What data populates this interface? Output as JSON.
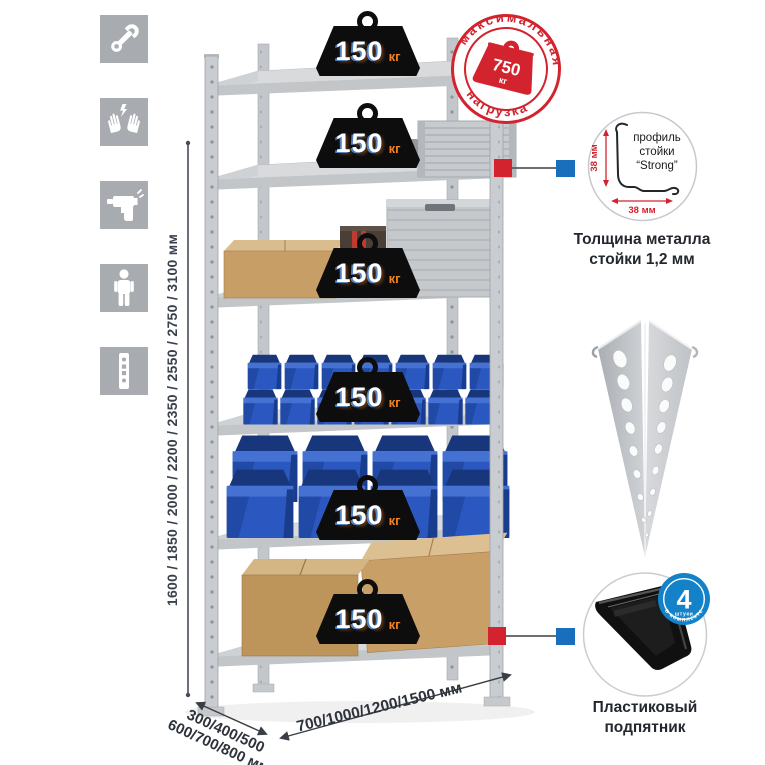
{
  "sidebar_icons": [
    {
      "label": "wrench"
    },
    {
      "label": "gloves"
    },
    {
      "label": "drill"
    },
    {
      "label": "person"
    },
    {
      "label": "perforated-profile"
    }
  ],
  "height_dimension": "1600 / 1850 / 2000 / 2200 / 2350 / 2550 / 2750 / 3100 мм",
  "depth_dimension": {
    "line1": "300/400/500",
    "line2": "600/700/800 мм"
  },
  "width_dimension": "700/1000/1200/1500 мм",
  "shelf_load_badge": {
    "value": "150",
    "unit": "кг"
  },
  "max_load_stamp": {
    "arc_top": "максимальная",
    "arc_bottom": "нагрузка",
    "value": "750",
    "unit": "кг"
  },
  "post_profile": {
    "label_line1": "профиль",
    "label_line2": "стойки",
    "label_line3": "“Strong”",
    "dim_vertical": "38 мм",
    "dim_horizontal": "38 мм",
    "caption_line1": "Толщина металла",
    "caption_line2": "стойки 1,2 мм"
  },
  "plastic_foot": {
    "badge_value": "4",
    "badge_unit": "штуки",
    "badge_arc": "в комплекте",
    "caption_line1": "Пластиковый",
    "caption_line2": "подпятник"
  },
  "colors": {
    "stamp_red": "#d2232e",
    "connector_blue": "#1a6fbd",
    "badge_blue": "#1482c8",
    "bin_blue": "#2b58c0",
    "weight_black": "#0d0d0d",
    "load_unit_orange": "#f08223",
    "metal_gray": "#ced1d4",
    "icon_gray": "#a8abaf"
  }
}
